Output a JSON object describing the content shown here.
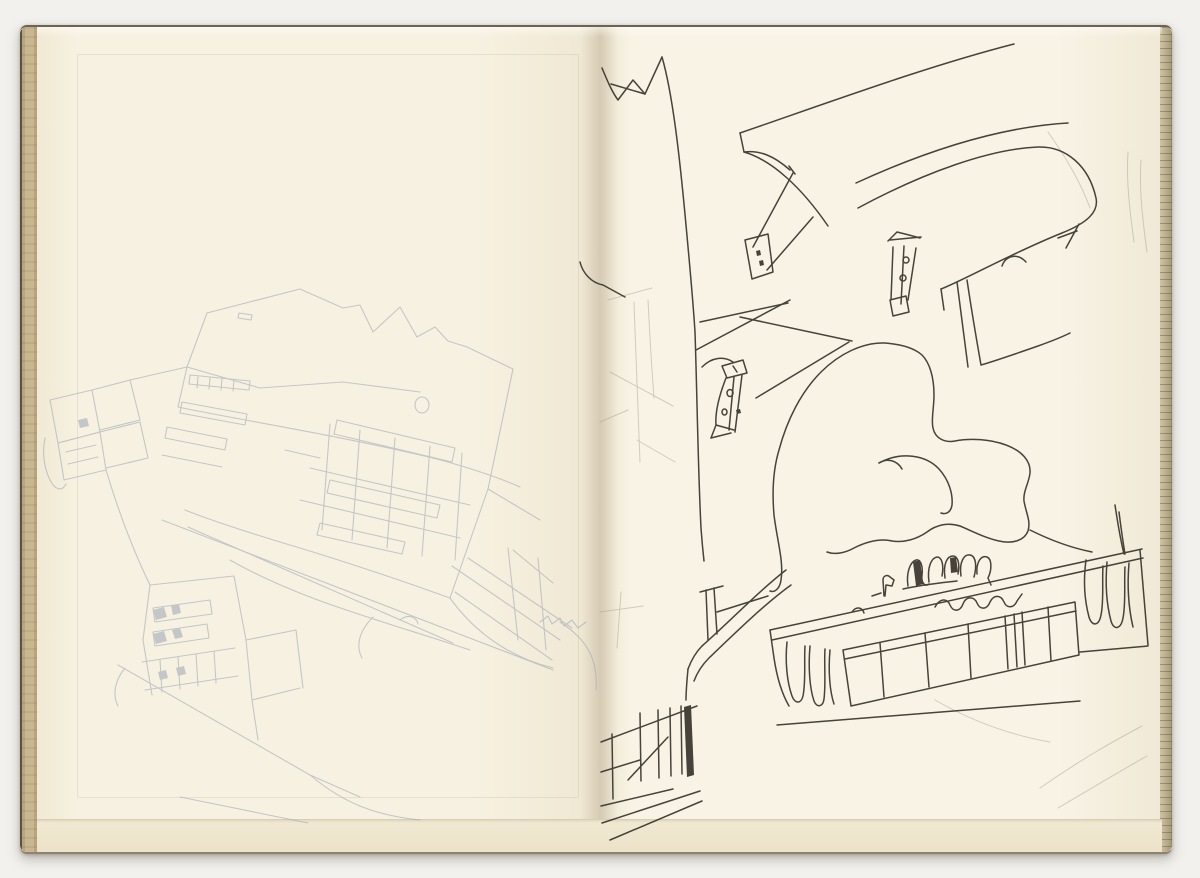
{
  "artwork": {
    "kind": "scanned sketchbook spread",
    "description": "Open sketchbook with two facing cream pages. Left page: very faint blue-grey pencil sketch of a tilted sawtooth-roofed building complex with banded windows and small annex buildings. Right page: black ink perspective sketch of a hall with suspended canopy roofs on braced struts, a large organic blob form in the centre, and a low glazed gallery band with tiny figures and melting drip shapes.",
    "left_page_medium": "faint blue-grey pencil",
    "right_page_medium": "black ink pen"
  },
  "palette": {
    "background": "#f2f1ee",
    "page_left": "#f7f1e1",
    "page_right": "#f8f3e5",
    "binding_edge": "#c9b790",
    "fore_edge": "#bfb392",
    "ink": "#38342c",
    "pencil_blue_grey": "#9fa9b6",
    "pencil_warm_grey": "#a8a496"
  },
  "sketch": {
    "width": 1200,
    "height": 878,
    "groups": [
      {
        "name": "left-page-pencil-sketch",
        "stroke": "#9fa9b6",
        "stroke_width": 1.1,
        "opacity": 0.58,
        "paths": [
          "M 207 313 L 300 289 L 343 308",
          "M 343 308 L 360 305 L 373 332 L 400 307 L 417 337 L 435 327 L 448 341 L 467 347 L 513 369",
          "M 513 369 L 488 489 L 450 598",
          "M 207 313 L 187 367 L 178 407",
          "M 187 367 L 260 388 L 343 382 L 420 392",
          "M 178 407 C 240 420 320 432 420 455 C 460 464 500 478 520 487",
          "M 450 598 C 400 580 340 560 290 545 C 250 533 210 520 185 510",
          "M 415 405 a 7 8 0 1 0 14 0 a 7 8 0 1 0 -14 0",
          "M 190 375 L 250 381 L 249 390 L 189 384 Z",
          "M 198 377 L 197 388 M 210 378 L 209 389 M 222 379 L 221 390 M 234 380 L 233 391",
          "M 239 313 L 252 315 L 251 320 L 238 318 Z",
          "M 337 420 L 455 448 L 452 462 L 334 434 Z",
          "M 330 480 L 440 505 L 437 518 L 327 493 Z",
          "M 320 523 L 405 542 L 402 554 L 317 535 Z",
          "M 285 450 L 320 458",
          "M 182 402 L 247 414 L 245 425 L 180 413 Z",
          "M 167 427 L 227 439 L 225 450 L 165 438 Z",
          "M 162 455 L 222 467",
          "M 360 430 L 352 540 M 395 438 L 387 548 M 430 446 L 422 556 M 462 453 L 455 560 M 330 424 L 322 530",
          "M 300 500 L 460 538 M 310 468 L 470 505",
          "M 50 400 L 92 390 L 100 432 L 58 443 Z",
          "M 58 443 L 100 432 L 106 470 L 64 480 Z",
          "M 66 452 L 96 445 M 68 464 L 98 457",
          "M 92 390 L 130 380 L 140 420 L 100 430",
          "M 100 432 L 140 422 L 148 458 L 106 468",
          "M 45 438 C 42 452 44 468 50 480 C 55 490 62 492 66 484",
          "M 130 380 L 187 367",
          "M 106 470 C 118 510 132 548 150 585",
          "M 150 585 L 234 576",
          "M 234 576 L 246 640 L 252 700 L 258 740",
          "M 150 585 L 143 640 L 152 695",
          "M 252 700 L 300 688 M 246 640 L 296 630 M 296 630 L 303 688",
          "M 153 608 L 210 600 L 212 614 L 155 622 Z",
          "M 153 632 L 207 624 L 209 638 L 155 646 Z",
          "M 142 662 L 235 648 M 145 690 L 238 676",
          "M 160 660 L 162 692 M 178 657 L 180 689 M 196 654 L 198 686 M 214 651 L 216 683",
          "M 118 665 L 310 775 L 360 797",
          "M 180 797 L 308 823",
          "M 125 668 C 115 680 112 695 118 706",
          "M 162 520 L 553 670",
          "M 188 527 L 453 643",
          "M 230 560 C 300 600 380 620 470 650",
          "M 513 550 L 553 583 M 488 489 L 540 520",
          "M 450 598 C 480 640 520 660 553 668",
          "M 373 617 C 360 630 355 645 362 658",
          "M 400 620 C 408 614 416 616 418 624",
          "M 452 566 L 560 640 M 468 558 L 572 628 M 455 592 L 552 660 M 508 548 L 518 640 M 538 558 L 546 650",
          "M 560 622 C 588 640 598 660 596 690",
          "M 540 622 L 548 616 L 552 624 L 560 618 L 564 626 L 572 620 L 578 628 L 586 622",
          "M 310 775 C 340 800 370 815 420 820"
        ],
        "fills": [
          "M 153 610 L 164 607 L 167 617 L 156 620 Z",
          "M 171 606 L 179 604 L 181 613 L 173 615 Z",
          "M 153 634 L 164 631 L 167 641 L 156 644 Z",
          "M 172 630 L 180 628 L 183 637 L 175 639 Z",
          "M 78 420 L 87 418 L 89 426 L 80 428 Z",
          "M 158 672 L 166 670 L 168 678 L 160 680 Z",
          "M 176 668 L 184 666 L 186 674 L 178 676 Z"
        ]
      },
      {
        "name": "right-page-pencil-marks",
        "stroke": "#a8a496",
        "stroke_width": 1.0,
        "opacity": 0.5,
        "paths": [
          "M 608 300 L 652 288",
          "M 634 302 C 636 360 638 420 640 462",
          "M 648 300 C 650 340 652 372 654 398",
          "M 610 372 L 673 406",
          "M 600 422 L 628 410",
          "M 637 440 L 675 462",
          "M 600 612 L 643 606",
          "M 621 592 L 617 648",
          "M 1128 152 C 1126 182 1130 212 1134 242",
          "M 1141 160 C 1139 192 1143 222 1147 252",
          "M 1040 788 C 1080 760 1112 742 1142 726",
          "M 1058 808 C 1092 788 1122 770 1147 756",
          "M 935 700 C 970 720 1010 735 1050 742",
          "M 1048 132 C 1068 160 1082 186 1090 208"
        ],
        "fills": []
      },
      {
        "name": "right-page-ink-sketch",
        "stroke": "#38342c",
        "stroke_width": 1.5,
        "opacity": 0.92,
        "paths": [
          "M 602 68 C 607 80 612 92 618 100 L 633 80 L 645 94 L 662 57",
          "M 611 84 L 645 94",
          "M 662 57 C 673 95 680 160 686 225 C 690 268 693 300 695 332 C 697 390 698 470 701 528 C 702 542 703 552 704 561",
          "M 580 262 C 583 274 592 283 603 285 L 625 297",
          "M 740 133 C 830 102 928 66 1014 44",
          "M 740 133 L 744 152 C 772 160 802 188 828 226",
          "M 744 152 C 760 150 774 156 790 170",
          "M 793 173 L 753 247",
          "M 813 217 L 767 270",
          "M 745 240 L 768 234 L 773 272 L 752 279 Z",
          "M 789 166 L 795 174",
          "M 858 208 C 925 172 990 149 1038 147 C 1066 146 1089 166 1096 198 C 1099 212 1087 223 1062 233 C 1012 253 962 281 941 289",
          "M 856 183 C 928 150 1000 127 1068 123",
          "M 941 289 L 944 310",
          "M 1002 266 C 1006 255 1018 253 1026 262",
          "M 890 240 L 921 237 M 893 247 L 891 300 M 904 246 L 901 304 M 916 248 L 908 300",
          "M 890 300 L 906 296 L 909 312 L 893 316 Z",
          "M 903 260 a 3 3 0 1 0 6 0 a 3 3 0 1 0 -6 0",
          "M 900 278 a 3 3 0 1 0 6 0 a 3 3 0 1 0 -6 0",
          "M 888 241 L 897 232 L 909 235 L 920 238",
          "M 1079 224 L 1066 248 M 1058 238 L 1077 231",
          "M 967 280 C 973 320 978 348 981 365 C 998 360 1018 353 1038 346 C 1052 341 1062 337 1070 333",
          "M 957 282 C 961 315 965 344 968 367",
          "M 696 350 L 790 300",
          "M 700 322 L 788 303",
          "M 740 317 L 852 341",
          "M 756 398 L 849 342",
          "M 702 367 C 712 357 724 356 733 362",
          "M 722 366 L 743 360 L 747 373 L 727 378 Z",
          "M 733 366 L 737 372",
          "M 726 378 C 719 396 715 412 716 425 L 711 438",
          "M 734 377 L 729 430",
          "M 742 375 L 735 432",
          "M 711 438 L 731 433 M 716 425 L 734 430",
          "M 727 393 a 3 3.5 0 1 0 6 0 a 3 3.5 0 1 0 -6 0",
          "M 722 412 a 2.5 3 0 1 0 5 0 a 2.5 3 0 1 0 -5 0",
          "M 770 591 C 775 593 780 588 781 580 C 784 562 777 540 774 515 C 772 492 773 470 779 450 C 787 420 801 392 821 372 C 839 354 863 342 885 343 C 898 344 913 347 922 355 C 930 363 934 378 934 395 C 934 408 931 420 933 428 C 935 438 944 443 955 441 C 970 438 990 439 1006 445 C 1022 451 1031 461 1030 473 C 1029 483 1023 491 1024 501 C 1026 513 1031 521 1028 531 C 1024 541 1012 544 999 541 C 985 538 972 531 960 526 C 948 522 936 525 927 532 C 917 539 904 543 892 541 C 879 538 866 542 854 548 C 845 553 835 555 827 552",
          "M 902 469 C 897 460 887 458 879 463",
          "M 879 463 C 901 451 926 455 939 469 C 949 480 953 494 952 505 C 951 512 946 515 941 513",
          "M 786 570 C 760 590 727 624 702 646 C 696 652 691 661 688 669",
          "M 791 585 C 766 603 737 631 709 658 C 702 665 697 673 694 681",
          "M 688 669 C 687 680 686 690 686 700",
          "M 706 590 L 708 640 M 714 588 L 717 634",
          "M 700 592 L 723 586",
          "M 717 612 L 768 596",
          "M 601 742 L 697 706",
          "M 612 734 L 613 799",
          "M 640 713 L 641 781 M 658 710 L 659 778 M 670 708 L 671 776 M 681 706 L 682 774",
          "M 601 772 L 640 760",
          "M 601 806 L 673 789",
          "M 602 823 L 700 791",
          "M 610 840 L 702 801",
          "M 628 780 L 668 737",
          "M 770 630 L 1142 549",
          "M 772 640 L 1143 558",
          "M 770 630 L 774 658 C 777 678 782 694 789 706",
          "M 777 725 L 1080 701",
          "M 1140 550 L 1148 645",
          "M 1080 652 L 1148 646",
          "M 843 650 L 1075 602 L 1079 655 L 851 706 Z",
          "M 845 659 L 1076 611",
          "M 880 643 L 884 697 M 925 633 L 929 687 M 968 624 L 971 678 M 1005 616 L 1008 669 M 1014 614 L 1017 667 M 1022 612 L 1025 665 M 1048 607 L 1051 661",
          "M 787 642 C 785 662 787 682 792 696 C 795 704 801 704 803 696 C 806 681 804 661 805 646",
          "M 810 646 C 808 669 810 689 814 701 C 817 708 823 707 824 699 C 826 683 824 663 825 649",
          "M 830 650 C 828 672 830 692 834 704",
          "M 1086 560 C 1083 582 1085 602 1089 617 C 1092 627 1099 626 1101 615 C 1104 601 1102 581 1103 566",
          "M 1107 562 C 1105 586 1107 606 1111 621 C 1114 631 1121 629 1123 618 C 1126 603 1124 583 1125 567",
          "M 1129 563 C 1127 587 1129 610 1133 627",
          "M 852 612 C 856 606 862 607 864 613",
          "M 935 607 C 940 598 947 598 950 605 C 953 612 960 612 963 604 C 966 596 974 596 977 603 C 980 610 987 610 990 602 C 994 594 1001 595 1004 602 C 1007 609 1014 608 1017 601 L 1022 594",
          "M 908 586 C 906 573 910 562 916 560 C 921 559 923 567 922 575 C 921 583 925 587 929 584",
          "M 929 582 C 927 568 931 558 937 557 C 942 557 944 565 942 576",
          "M 945 578 C 943 564 947 556 953 556 C 958 556 960 564 958 574",
          "M 961 576 C 959 562 964 554 970 555 C 976 556 977 566 974 577",
          "M 977 574 C 976 562 981 555 987 557 C 992 559 992 570 988 578 L 991 585",
          "M 884 596 L 883 580 C 883 576 887 574 890 577 L 894 580 L 892 586 L 886 585 L 885 596",
          "M 872 596 L 881 593",
          "M 903 589 C 920 585 940 583 957 581",
          "M 1030 530 C 1052 541 1072 548 1092 552",
          "M 1115 505 C 1118 525 1121 542 1124 554",
          "M 1119 512 C 1121 528 1123 542 1125 554"
        ],
        "fills": [
          "M 756 251 L 760 250 L 761 255 L 757 256 Z",
          "M 759 261 L 763 260 L 764 265 L 760 266 Z",
          "M 684 707 L 691 705 L 694 775 L 687 777 Z",
          "M 913 562 L 920 560 L 923 584 L 916 586 Z",
          "M 950 558 L 956 557 L 958 572 L 951 573 Z",
          "M 736 410 L 740 409 L 741 413 L 737 414 Z"
        ]
      }
    ]
  }
}
